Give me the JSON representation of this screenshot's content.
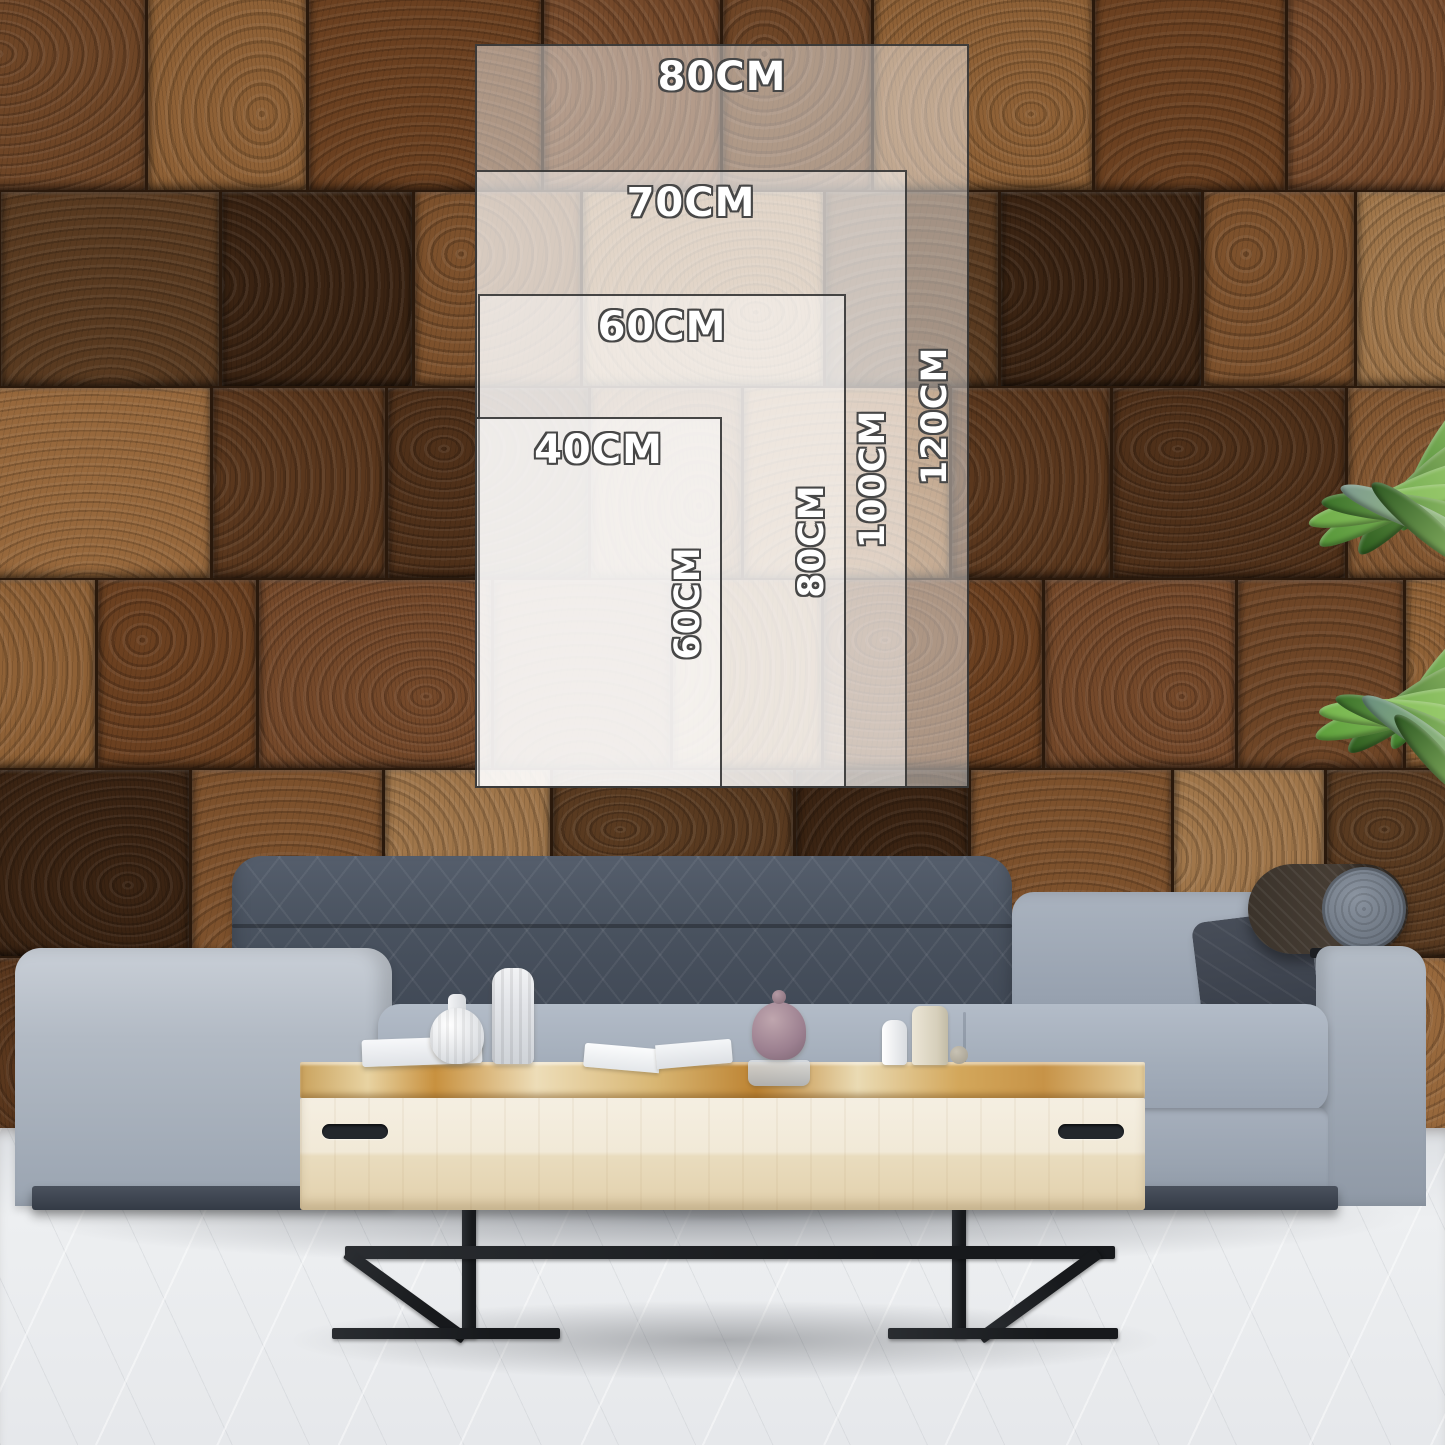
{
  "size_guide": {
    "unit": "CM",
    "orientation": "portrait",
    "sizes": [
      {
        "width_label": "80CM",
        "height_label": "120CM",
        "width_cm": 80,
        "height_cm": 120
      },
      {
        "width_label": "70CM",
        "height_label": "100CM",
        "width_cm": 70,
        "height_cm": 100
      },
      {
        "width_label": "60CM",
        "height_label": "80CM",
        "width_cm": 60,
        "height_cm": 80
      },
      {
        "width_label": "40CM",
        "height_label": "60CM",
        "width_cm": 40,
        "height_cm": 60
      }
    ],
    "label_text_color": "#ffffff",
    "label_outline_color": "#474747",
    "panel_fill": "rgba(255,255,255,0.45)",
    "panel_border_color": "#2d2d2d"
  },
  "scene": {
    "wall_style": "wood-end-grain-blocks",
    "wall_palette": [
      "#6e4526",
      "#5a371d",
      "#7d512c",
      "#8f6136",
      "#4f3019",
      "#a0764a",
      "#6b4020",
      "#845832",
      "#593a20",
      "#75492a",
      "#97683c",
      "#3a2312"
    ],
    "floor_color": "#e9ebee",
    "sofa_fabric_color": "#a3adba",
    "sofa_back_cushion_color": "#49515f",
    "bolster_color": "#3b332b",
    "table_wood_color": "#ead9b4",
    "table_grain_color": "#c08434",
    "metal_leg_color": "#1f2328",
    "plant_green_color": "#4c8a33"
  }
}
